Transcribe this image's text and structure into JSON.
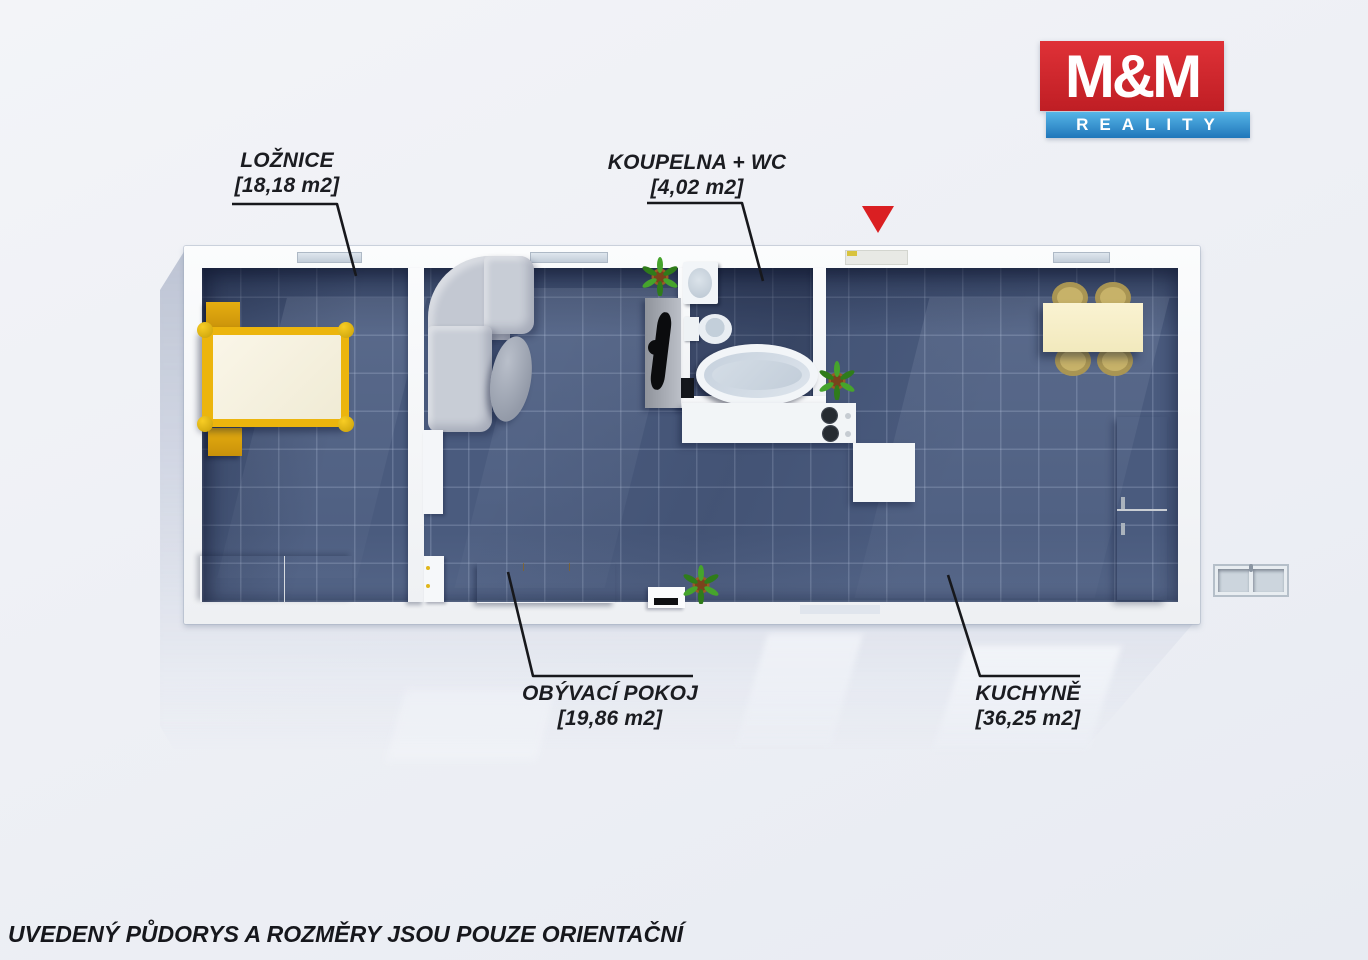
{
  "logo": {
    "primary": "M&M",
    "secondary": "REALITY"
  },
  "plan": {
    "rooms": [
      {
        "id": "loznice",
        "label": "LOŽNICE",
        "area": "[18,18 m2]"
      },
      {
        "id": "koupelna_wc",
        "label": "KOUPELNA + WC",
        "area": "[4,02 m2]"
      },
      {
        "id": "obyvaci_pokoj",
        "label": "OBÝVACÍ POKOJ",
        "area": "[19,86 m2]"
      },
      {
        "id": "kuchyne",
        "label": "KUCHYNĚ",
        "area": "[36,25 m2]"
      }
    ]
  },
  "footer": {
    "disclaimer": "UVEDENÝ PŮDORYS A ROZMĚRY JSOU POUZE ORIENTAČNÍ"
  },
  "colors": {
    "logo_red": "#cf2127",
    "logo_blue": "#2e8fd0",
    "entrance_marker": "#da1f22",
    "floor_tile": "#4a5b7e",
    "furniture_accent": "#e8a90e"
  },
  "icons": {
    "entrance_marker": "red-triangle-down"
  }
}
